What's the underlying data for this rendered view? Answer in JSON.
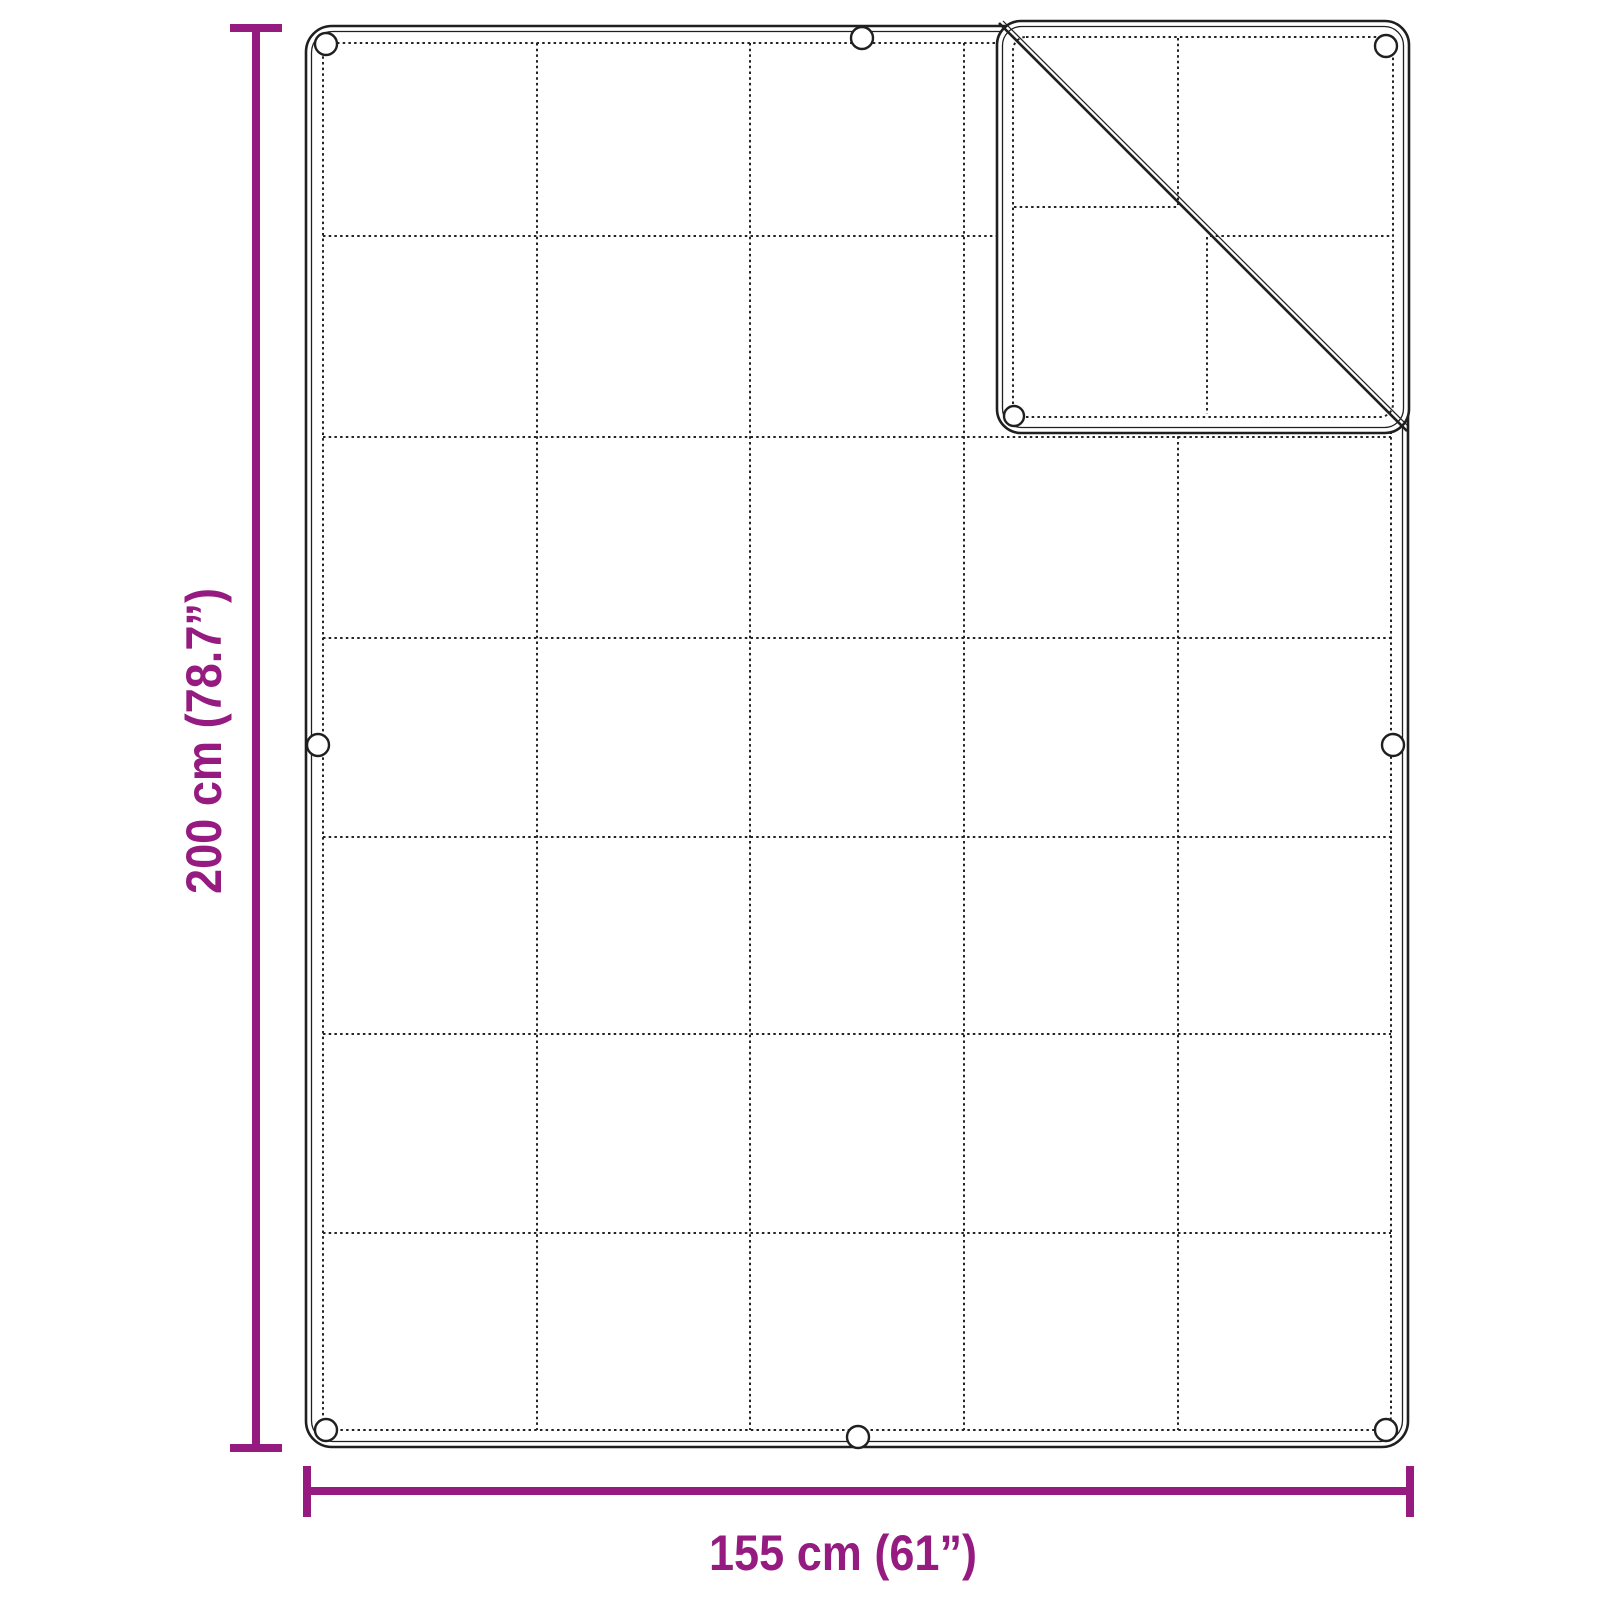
{
  "diagram": {
    "kind": "product-dimension-diagram",
    "dimensions": {
      "height_label": "200 cm (78.7”)",
      "width_label": "155 cm (61”)"
    },
    "colors": {
      "dimension_accent": "#951b81",
      "line_art": "#1f1f1f",
      "background": "#ffffff"
    },
    "blanket": {
      "grid_columns": 5,
      "grid_rows": 7,
      "grommets_visible": 9,
      "folded_corner": "top-right"
    }
  }
}
